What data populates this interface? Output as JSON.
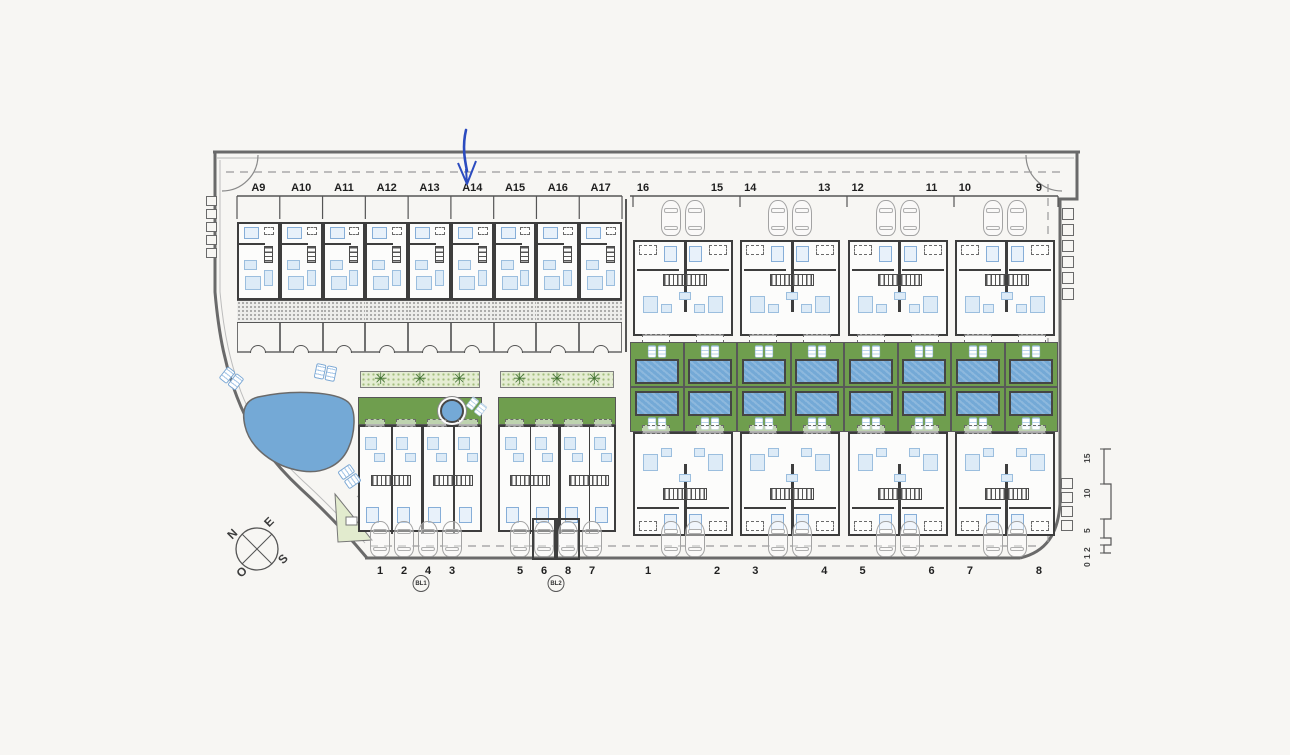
{
  "plan": {
    "row_a": {
      "units": [
        {
          "label": "A9"
        },
        {
          "label": "A10"
        },
        {
          "label": "A11"
        },
        {
          "label": "A12"
        },
        {
          "label": "A13"
        },
        {
          "label": "A14"
        },
        {
          "label": "A15"
        },
        {
          "label": "A16"
        },
        {
          "label": "A17"
        }
      ]
    },
    "row_top_right": {
      "buildings": [
        {
          "left": "16",
          "right": "15"
        },
        {
          "left": "14",
          "right": "13"
        },
        {
          "left": "12",
          "right": "11"
        },
        {
          "left": "10",
          "right": "9"
        }
      ]
    },
    "row_bottom_right": {
      "buildings": [
        {
          "left": "1",
          "right": "2"
        },
        {
          "left": "3",
          "right": "4"
        },
        {
          "left": "5",
          "right": "6"
        },
        {
          "left": "7",
          "right": "8"
        }
      ]
    },
    "bl_blocks": [
      {
        "badge": "BL1",
        "unit_labels": [
          "1",
          "2",
          "4",
          "3"
        ],
        "has_round_pool": true,
        "covered_parking": []
      },
      {
        "badge": "BL2",
        "unit_labels": [
          "5",
          "6",
          "8",
          "7"
        ],
        "has_round_pool": false,
        "covered_parking": [
          1,
          2
        ]
      }
    ],
    "compass": {
      "north": "N",
      "east": "E",
      "south": "S",
      "west": "O"
    },
    "scale_bar": {
      "ticks": [
        "0",
        "1",
        "2",
        "5",
        "10",
        "15"
      ]
    },
    "annotation_arrow": {
      "points_to": "A14",
      "color": "#2b4bbf"
    },
    "icons": {
      "palm_glyph": "✳",
      "palm": "palm-tree-icon",
      "car": "car-icon",
      "lounger": "sun-lounger-icon",
      "compass": "compass-rose-icon",
      "scale": "graphic-scale-bar"
    },
    "colors": {
      "paper": "#f7f6f3",
      "garden_green": "#6f9e4e",
      "hatch_green": "#e5edd3",
      "pool_blue": "#74a9d6",
      "furniture_blue": "#ddebf7",
      "wall_dark": "#3d3d3d",
      "line_gray": "#6a6a6a",
      "arrow_blue": "#2b4bbf"
    }
  }
}
